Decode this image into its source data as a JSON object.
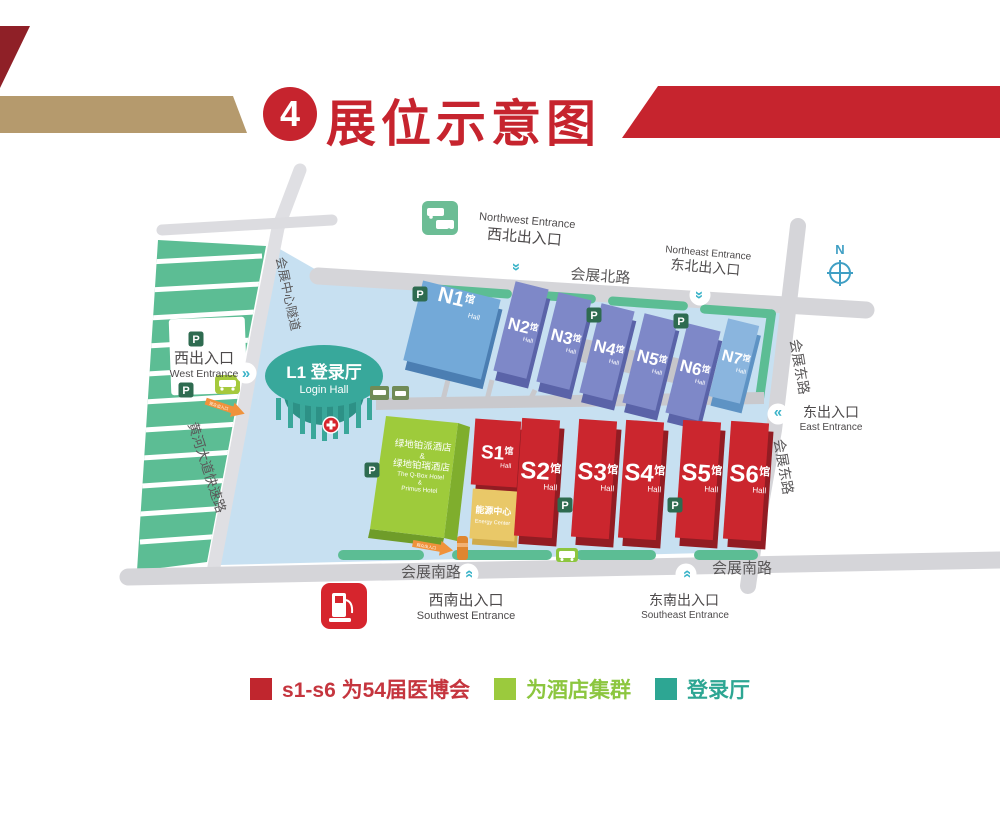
{
  "header": {
    "number": "4",
    "title": "展位示意图"
  },
  "map": {
    "compass": "N",
    "parking": "P",
    "arrow": "»",
    "visitor_arrow": "观众出入口",
    "roads": {
      "north": "会展北路",
      "south_left": "会展南路",
      "south_right": "会展南路",
      "east_upper": "会展东路",
      "east_lower": "会展东路",
      "tunnel": "会展中心隧道",
      "expressway": "黄河大道快速路"
    },
    "entrances": {
      "northwest": {
        "zh": "西北出入口",
        "en": "Northwest Entrance"
      },
      "northeast": {
        "zh": "东北出入口",
        "en": "Northeast Entrance"
      },
      "west": {
        "zh": "西出入口",
        "en": "West Entrance"
      },
      "east": {
        "zh": "东出入口",
        "en": "East Entrance"
      },
      "southwest": {
        "zh": "西南出入口",
        "en": "Southwest Entrance"
      },
      "southeast": {
        "zh": "东南出入口",
        "en": "Southeast Entrance"
      }
    },
    "login_hall": {
      "title": "L1 登录厅",
      "subtitle": "Login Hall"
    },
    "hotel": {
      "line1": "绿地铂派酒店",
      "amp1": "&",
      "line2": "绿地铂瑞酒店",
      "line3": "The Q-Box Hotel",
      "amp2": "&",
      "line4": "Primus Hotel"
    },
    "energy_center": {
      "zh": "能源中心",
      "en": "Energy Center"
    },
    "halls_n": [
      {
        "name": "N1",
        "suffix": "馆",
        "sub": "Hall"
      },
      {
        "name": "N2",
        "suffix": "馆",
        "sub": "Hall"
      },
      {
        "name": "N3",
        "suffix": "馆",
        "sub": "Hall"
      },
      {
        "name": "N4",
        "suffix": "馆",
        "sub": "Hall"
      },
      {
        "name": "N5",
        "suffix": "馆",
        "sub": "Hall"
      },
      {
        "name": "N6",
        "suffix": "馆",
        "sub": "Hall"
      },
      {
        "name": "N7",
        "suffix": "馆",
        "sub": "Hall"
      }
    ],
    "halls_s": [
      {
        "name": "S1",
        "suffix": "馆",
        "sub": "Hall"
      },
      {
        "name": "S2",
        "suffix": "馆",
        "sub": "Hall"
      },
      {
        "name": "S3",
        "suffix": "馆",
        "sub": "Hall"
      },
      {
        "name": "S4",
        "suffix": "馆",
        "sub": "Hall"
      },
      {
        "name": "S5",
        "suffix": "馆",
        "sub": "Hall"
      },
      {
        "name": "S6",
        "suffix": "馆",
        "sub": "Hall"
      }
    ]
  },
  "legend": {
    "items": [
      {
        "label": "s1-s6 为54届医博会",
        "text_color": "#c5353e",
        "swatch": "#c0262e"
      },
      {
        "label": "为酒店集群",
        "text_color": "#8cc63f",
        "swatch": "#9bca3d"
      },
      {
        "label": "登录厅",
        "text_color": "#2da693",
        "swatch": "#2da693"
      }
    ]
  }
}
